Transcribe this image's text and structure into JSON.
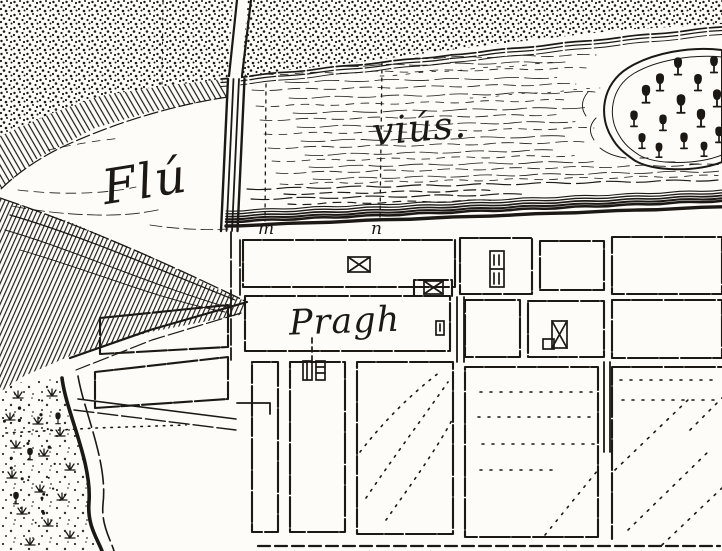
{
  "map": {
    "type": "historical-engraved-town-plan",
    "labels": {
      "river_part1": "Flú",
      "river_part2": "viús.",
      "town": "Pragh",
      "marker_m": "m",
      "marker_n": "n"
    },
    "colors": {
      "ink": "#1c1814",
      "paper": "#fdfcf8"
    },
    "features": [
      {
        "name": "stippled-fields"
      },
      {
        "name": "river-fluvius"
      },
      {
        "name": "hatched-river-banks"
      },
      {
        "name": "bridge"
      },
      {
        "name": "wooded-island"
      },
      {
        "name": "survey-line-m"
      },
      {
        "name": "survey-line-n"
      },
      {
        "name": "town-street-grid"
      },
      {
        "name": "building-symbols"
      },
      {
        "name": "riverside-road"
      },
      {
        "name": "vegetation"
      }
    ]
  }
}
